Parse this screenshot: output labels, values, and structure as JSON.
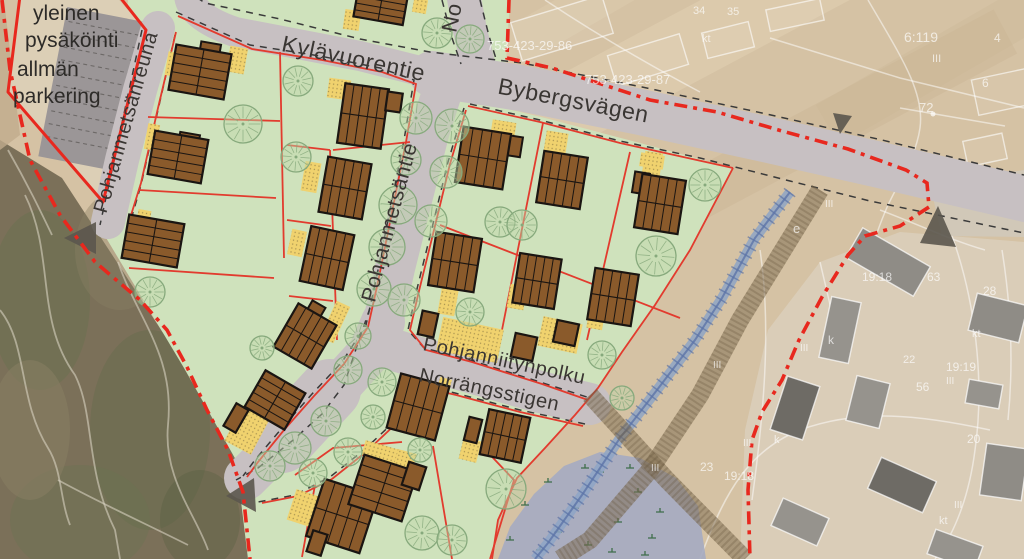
{
  "map_title": "Detail plan illustration over aerial photo",
  "colors": {
    "plan_green": "#cfe2bc",
    "road_gray": "#c7c0c2",
    "parking_gray": "#9b9697",
    "parking_enclosure_tan": "#dccfb6",
    "building_brown": "#8a5a2b",
    "building_outline": "#1a1512",
    "lot_line_red": "#e23b2e",
    "boundary_red": "#e8281e",
    "yard_yellow": "#f0d26e",
    "tree_green": "#86a97c",
    "aerial_tan": "#d5c2a4",
    "forest_dark": "#7b7059",
    "wetland_blue": "#a6abc1",
    "stream_blue": "#5d74a8",
    "path_brown": "#7c6a4d",
    "arrow_gray": "#5b564e",
    "label_dark": "#3a3633",
    "cadastral_white": "#ffffff"
  },
  "labels": {
    "parking": [
      {
        "t": "yleinen",
        "x": 33,
        "y": 20
      },
      {
        "t": "pysäköinti",
        "x": 25,
        "y": 47
      },
      {
        "t": "allmän",
        "x": 17,
        "y": 76
      },
      {
        "t": "parkering",
        "x": 13,
        "y": 103
      }
    ],
    "streets": [
      {
        "t": "Kylävuorentie",
        "x": 352,
        "y": 66,
        "rot": 12,
        "s": 23
      },
      {
        "t": "Bybergsvägen",
        "x": 572,
        "y": 108,
        "rot": 11,
        "s": 23
      },
      {
        "t": "Pohjanmetsäntie",
        "x": 396,
        "y": 224,
        "rot": -75,
        "s": 21
      },
      {
        "t": "Pohjanmetsänreuna",
        "x": 132,
        "y": 124,
        "rot": -74,
        "s": 20
      },
      {
        "t": "Pohjanniitynpolku",
        "x": 503,
        "y": 367,
        "rot": 12,
        "s": 20
      },
      {
        "t": "Norrängsstigen",
        "x": 488,
        "y": 396,
        "rot": 12,
        "s": 20
      },
      {
        "t": "No",
        "x": 459,
        "y": 19,
        "rot": -78,
        "s": 22
      }
    ],
    "cadastral": [
      {
        "t": "753-423-29-86",
        "x": 487,
        "y": 50,
        "s": 13
      },
      {
        "t": "753-423-29-87",
        "x": 585,
        "y": 84,
        "s": 13
      },
      {
        "t": "34",
        "x": 693,
        "y": 14,
        "s": 11
      },
      {
        "t": "35",
        "x": 727,
        "y": 15,
        "s": 11
      },
      {
        "t": "kt",
        "x": 702,
        "y": 42,
        "s": 11
      },
      {
        "t": "6:119",
        "x": 904,
        "y": 42,
        "s": 14
      },
      {
        "t": "III",
        "x": 932,
        "y": 62,
        "s": 11
      },
      {
        "t": "72",
        "x": 919,
        "y": 112,
        "s": 13
      },
      {
        "t": "4",
        "x": 994,
        "y": 42,
        "s": 12
      },
      {
        "t": "6",
        "x": 982,
        "y": 87,
        "s": 12
      },
      {
        "t": "e",
        "x": 793,
        "y": 233,
        "s": 13
      },
      {
        "t": "III",
        "x": 825,
        "y": 207,
        "s": 10
      },
      {
        "t": "19:18",
        "x": 862,
        "y": 281,
        "s": 12
      },
      {
        "t": "63",
        "x": 927,
        "y": 281,
        "s": 12
      },
      {
        "t": "28",
        "x": 983,
        "y": 295,
        "s": 12
      },
      {
        "t": "k",
        "x": 828,
        "y": 344,
        "s": 12
      },
      {
        "t": "kt",
        "x": 972,
        "y": 337,
        "s": 11
      },
      {
        "t": "22",
        "x": 903,
        "y": 363,
        "s": 11
      },
      {
        "t": "19:19",
        "x": 946,
        "y": 371,
        "s": 12
      },
      {
        "t": "III",
        "x": 946,
        "y": 384,
        "s": 10
      },
      {
        "t": "56",
        "x": 916,
        "y": 391,
        "s": 12
      },
      {
        "t": "III",
        "x": 800,
        "y": 351,
        "s": 10
      },
      {
        "t": "III",
        "x": 713,
        "y": 368,
        "s": 10
      },
      {
        "t": "20",
        "x": 967,
        "y": 443,
        "s": 12
      },
      {
        "t": "III",
        "x": 651,
        "y": 471,
        "s": 10
      },
      {
        "t": "23",
        "x": 700,
        "y": 471,
        "s": 12
      },
      {
        "t": "19:18",
        "x": 724,
        "y": 480,
        "s": 12
      },
      {
        "t": "III",
        "x": 743,
        "y": 446,
        "s": 10
      },
      {
        "t": "k",
        "x": 774,
        "y": 443,
        "s": 11
      },
      {
        "t": "III",
        "x": 954,
        "y": 508,
        "s": 10
      },
      {
        "t": "kt",
        "x": 939,
        "y": 524,
        "s": 11
      }
    ]
  },
  "features": {
    "buildings": [
      [
        200,
        72,
        56,
        46,
        10
      ],
      [
        178,
        157,
        54,
        44,
        10
      ],
      [
        153,
        241,
        56,
        44,
        10
      ],
      [
        363,
        116,
        44,
        60,
        8
      ],
      [
        345,
        188,
        44,
        56,
        10
      ],
      [
        327,
        258,
        44,
        56,
        12
      ],
      [
        305,
        336,
        44,
        50,
        30
      ],
      [
        275,
        400,
        46,
        42,
        30
      ],
      [
        236,
        418,
        14,
        26,
        30
      ],
      [
        418,
        407,
        50,
        56,
        15
      ],
      [
        342,
        516,
        56,
        60,
        18
      ],
      [
        383,
        488,
        56,
        52,
        18
      ],
      [
        505,
        436,
        42,
        46,
        12
      ],
      [
        414,
        476,
        18,
        24,
        18
      ],
      [
        473,
        430,
        13,
        24,
        14
      ],
      [
        317,
        543,
        15,
        22,
        18
      ],
      [
        483,
        158,
        48,
        56,
        9
      ],
      [
        562,
        180,
        44,
        52,
        9
      ],
      [
        660,
        204,
        44,
        54,
        9
      ],
      [
        455,
        262,
        46,
        54,
        9
      ],
      [
        537,
        281,
        42,
        50,
        9
      ],
      [
        613,
        297,
        44,
        52,
        9
      ],
      [
        428,
        324,
        16,
        24,
        12
      ],
      [
        566,
        333,
        22,
        22,
        12
      ],
      [
        524,
        347,
        22,
        24,
        12
      ],
      [
        381,
        4,
        50,
        34,
        10
      ],
      [
        394,
        102,
        15,
        19,
        8
      ]
    ],
    "wings": [
      [
        210,
        50,
        20,
        14,
        10
      ],
      [
        189,
        140,
        20,
        13,
        10
      ],
      [
        513,
        146,
        17,
        20,
        9
      ],
      [
        641,
        183,
        15,
        21,
        9
      ],
      [
        315,
        311,
        15,
        16,
        30
      ]
    ],
    "trees": [
      [
        437,
        33,
        15
      ],
      [
        470,
        39,
        14
      ],
      [
        416,
        118,
        16
      ],
      [
        452,
        126,
        17
      ],
      [
        406,
        160,
        15
      ],
      [
        446,
        172,
        16
      ],
      [
        398,
        205,
        19
      ],
      [
        431,
        221,
        16
      ],
      [
        387,
        247,
        18
      ],
      [
        374,
        289,
        17
      ],
      [
        404,
        300,
        16
      ],
      [
        358,
        336,
        13
      ],
      [
        348,
        370,
        14
      ],
      [
        382,
        382,
        14
      ],
      [
        326,
        421,
        15
      ],
      [
        295,
        448,
        16
      ],
      [
        270,
        466,
        15
      ],
      [
        348,
        452,
        14
      ],
      [
        373,
        417,
        12
      ],
      [
        313,
        473,
        14
      ],
      [
        420,
        450,
        12
      ],
      [
        506,
        489,
        20
      ],
      [
        422,
        533,
        17
      ],
      [
        452,
        540,
        15
      ],
      [
        243,
        124,
        19
      ],
      [
        298,
        81,
        15
      ],
      [
        296,
        157,
        15
      ],
      [
        150,
        292,
        15
      ],
      [
        262,
        348,
        12
      ],
      [
        500,
        222,
        15
      ],
      [
        522,
        225,
        15
      ],
      [
        705,
        185,
        16
      ],
      [
        656,
        256,
        20
      ],
      [
        602,
        355,
        14
      ],
      [
        622,
        398,
        12
      ],
      [
        470,
        312,
        14
      ]
    ],
    "yard_patches": [
      [
        172,
        64,
        11,
        24,
        10
      ],
      [
        237,
        60,
        18,
        26,
        10
      ],
      [
        152,
        137,
        12,
        26,
        10
      ],
      [
        143,
        222,
        13,
        24,
        10
      ],
      [
        339,
        89,
        22,
        20,
        8
      ],
      [
        311,
        177,
        16,
        30,
        10
      ],
      [
        297,
        243,
        15,
        26,
        12
      ],
      [
        335,
        322,
        15,
        40,
        25
      ],
      [
        352,
        20,
        16,
        20,
        8
      ],
      [
        420,
        6,
        14,
        14,
        10
      ],
      [
        502,
        138,
        24,
        34,
        9
      ],
      [
        556,
        143,
        22,
        22,
        9
      ],
      [
        651,
        173,
        18,
        42,
        9
      ],
      [
        448,
        302,
        17,
        26,
        10
      ],
      [
        517,
        297,
        17,
        24,
        10
      ],
      [
        596,
        318,
        16,
        22,
        10
      ],
      [
        470,
        340,
        62,
        34,
        12
      ],
      [
        560,
        335,
        40,
        30,
        12
      ],
      [
        247,
        430,
        30,
        40,
        28
      ],
      [
        443,
        390,
        12,
        24,
        15
      ],
      [
        404,
        463,
        20,
        24,
        15
      ],
      [
        303,
        508,
        24,
        32,
        18
      ],
      [
        380,
        452,
        34,
        15,
        16
      ],
      [
        470,
        450,
        18,
        22,
        14
      ],
      [
        652,
        161,
        24,
        14,
        9
      ]
    ],
    "marsh_tufts": [
      [
        525,
        505
      ],
      [
        548,
        482
      ],
      [
        575,
        508
      ],
      [
        600,
        472
      ],
      [
        558,
        532
      ],
      [
        588,
        545
      ],
      [
        618,
        522
      ],
      [
        638,
        492
      ],
      [
        612,
        552
      ],
      [
        540,
        550
      ],
      [
        652,
        538
      ],
      [
        585,
        468
      ],
      [
        630,
        468
      ],
      [
        660,
        512
      ],
      [
        510,
        540
      ],
      [
        645,
        555
      ]
    ],
    "arrows": [
      [
        [
          64,
          238
        ],
        [
          96,
          222
        ],
        [
          96,
          254
        ]
      ],
      [
        [
          226,
          496
        ],
        [
          254,
          478
        ],
        [
          256,
          512
        ]
      ],
      [
        [
          920,
          243
        ],
        [
          956,
          247
        ],
        [
          938,
          206
        ]
      ],
      [
        [
          833,
          113
        ],
        [
          852,
          116
        ],
        [
          840,
          134
        ]
      ]
    ],
    "aerial_buildings": [
      [
        888,
        262,
        78,
        34,
        30,
        "#8f8c86"
      ],
      [
        840,
        330,
        30,
        62,
        12,
        "#96938d"
      ],
      [
        998,
        318,
        52,
        38,
        14,
        "#8f8c86"
      ],
      [
        984,
        394,
        34,
        24,
        10,
        "#96938d"
      ],
      [
        795,
        408,
        34,
        56,
        18,
        "#6e6b65"
      ],
      [
        868,
        402,
        34,
        46,
        14,
        "#96938d"
      ],
      [
        902,
        485,
        60,
        34,
        24,
        "#6e6b65"
      ],
      [
        800,
        522,
        50,
        30,
        24,
        "#96938d"
      ],
      [
        1004,
        472,
        42,
        52,
        8,
        "#8f8c86"
      ],
      [
        955,
        550,
        50,
        26,
        20,
        "#96938d"
      ]
    ],
    "aerial_outlines": [
      [
        562,
        28,
        95,
        40,
        -17
      ],
      [
        648,
        60,
        75,
        32,
        -17
      ],
      [
        728,
        40,
        48,
        26,
        -14
      ],
      [
        795,
        15,
        55,
        22,
        -12
      ],
      [
        1002,
        92,
        55,
        36,
        -12
      ],
      [
        985,
        150,
        40,
        26,
        -12
      ]
    ]
  }
}
